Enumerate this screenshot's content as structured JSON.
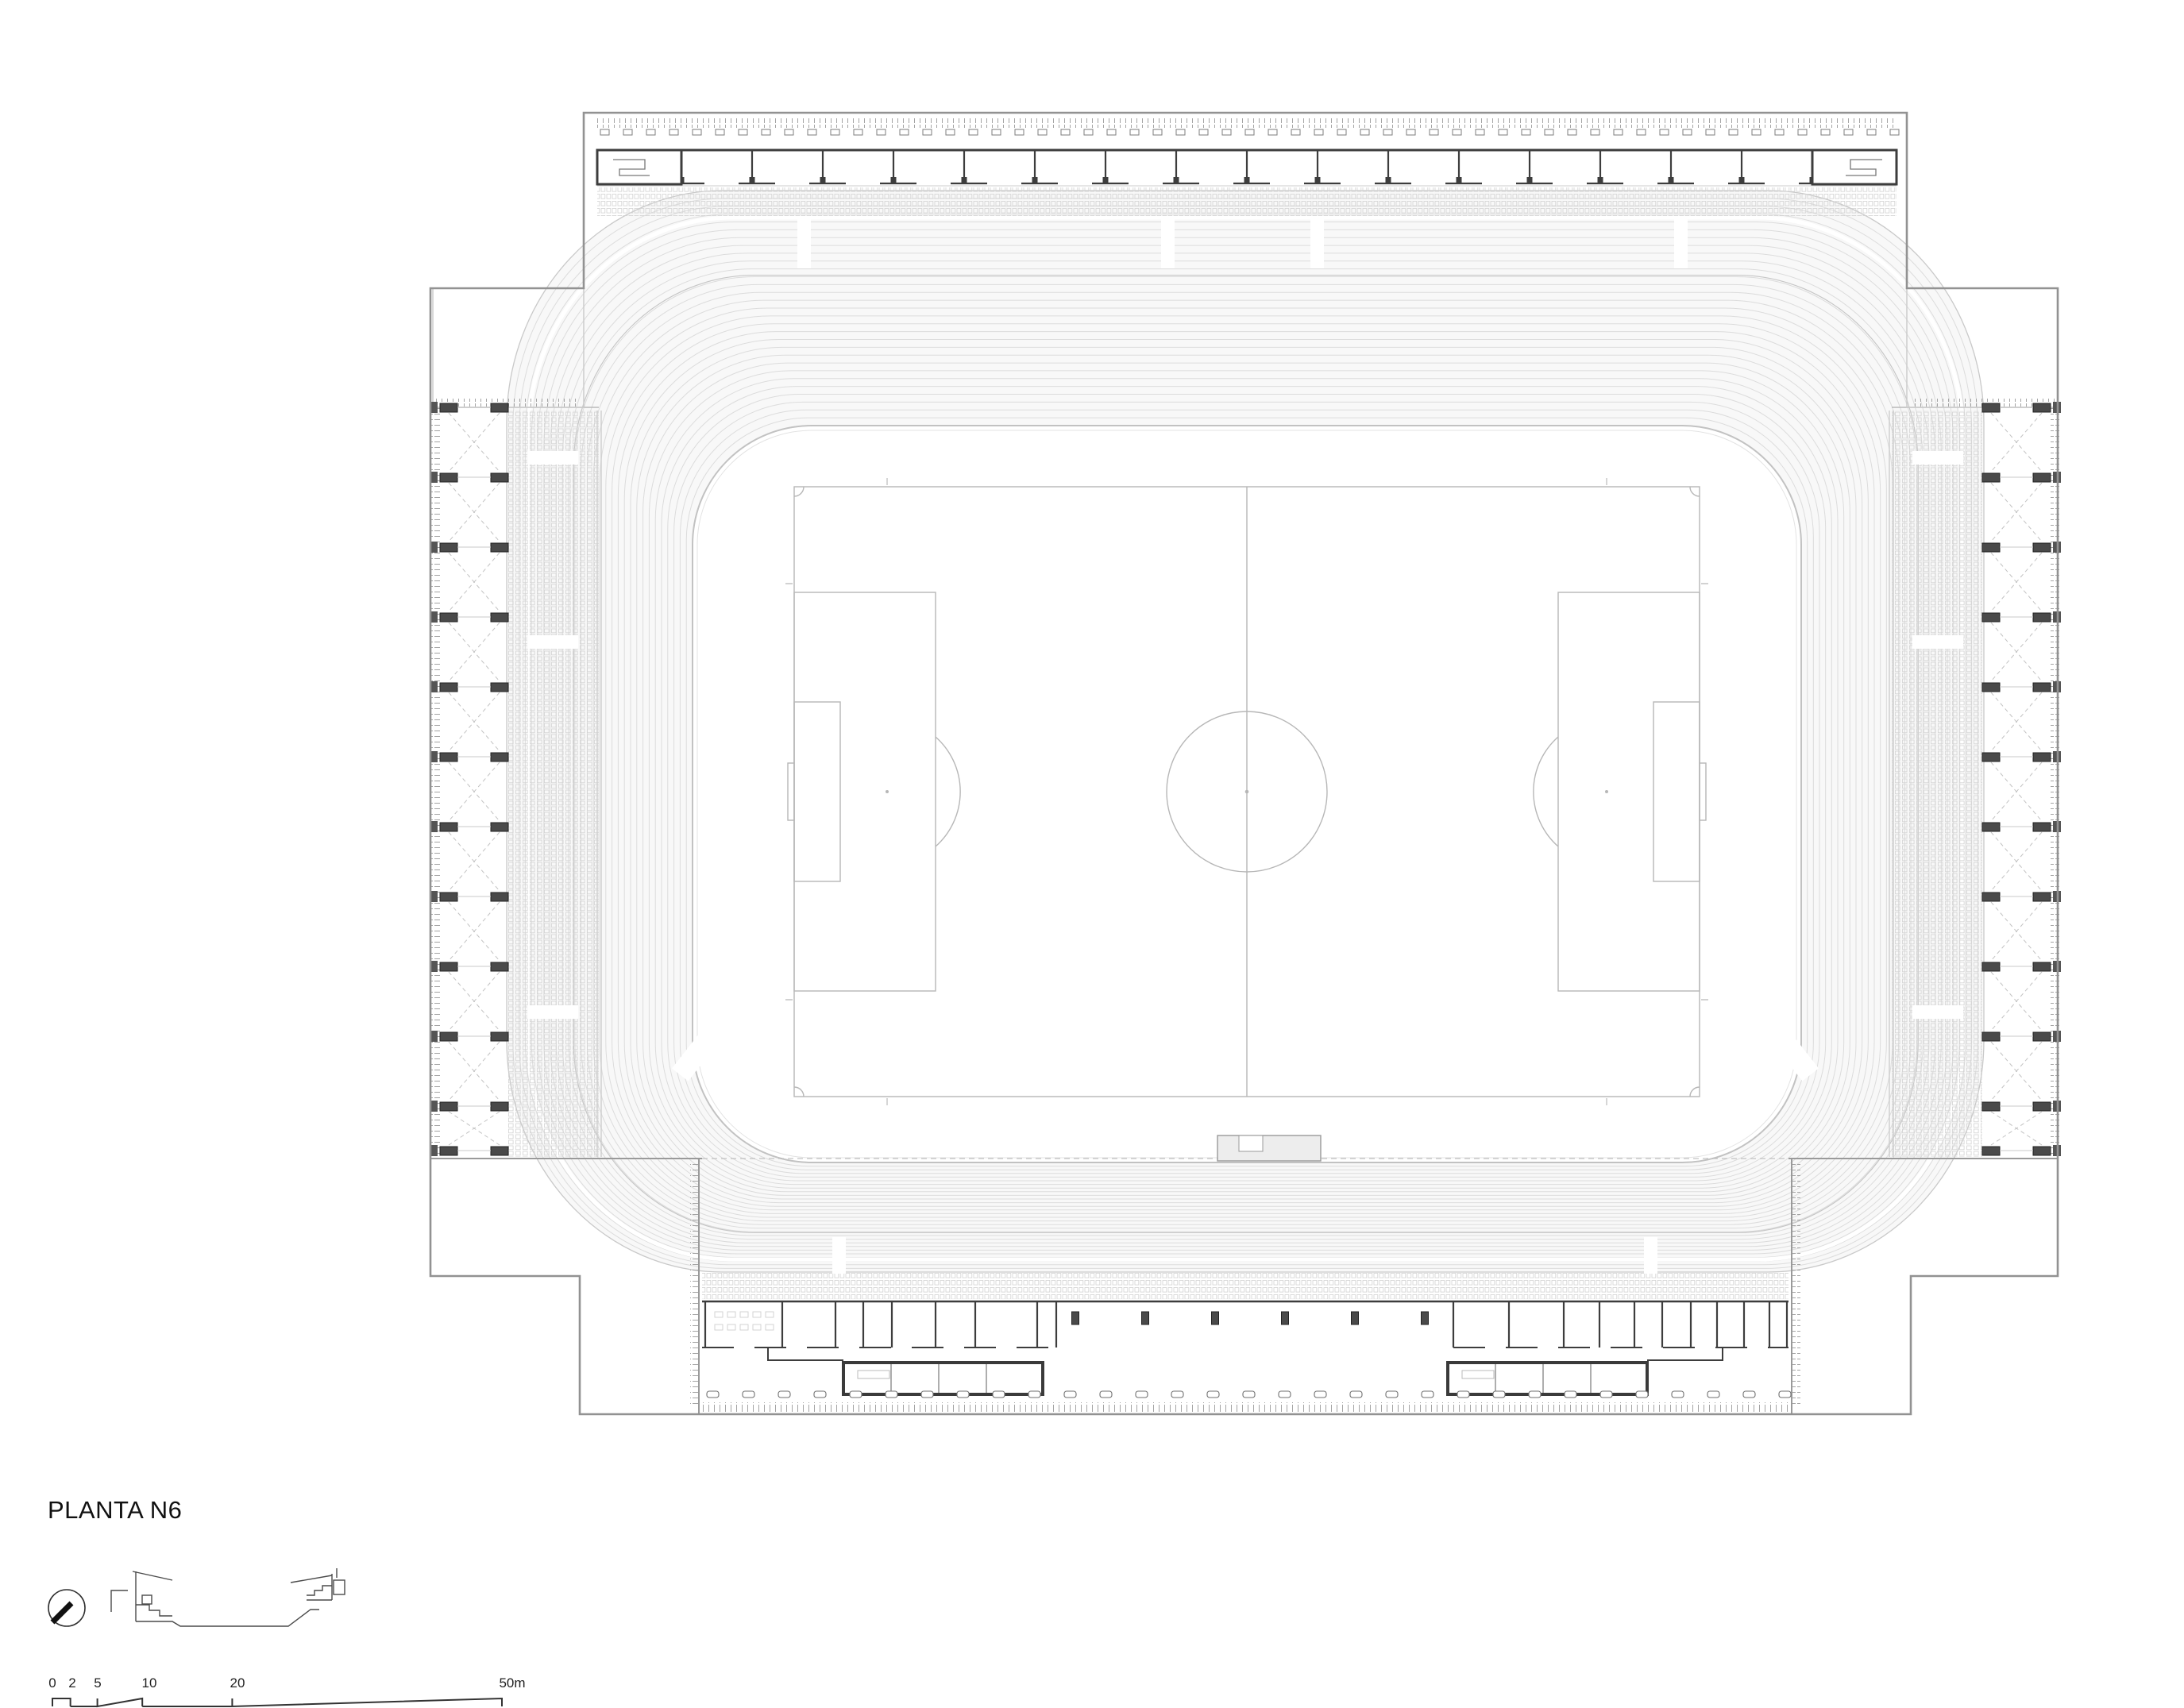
{
  "drawing": {
    "title": "PLANTA N6",
    "type_note": "stadium floor plan, level N6"
  },
  "scale_bar": {
    "marks": [
      0,
      2,
      5,
      10,
      20,
      50
    ],
    "labels": [
      "0",
      "2",
      "5",
      "10",
      "20",
      "50m"
    ],
    "unit": "m"
  },
  "icons": {
    "north": "north-arrow-icon",
    "section": "section-key-icon"
  },
  "colors": {
    "outline": "#929292",
    "light_line": "#c9c9c9",
    "row_line": "#dcdcdc",
    "dark_wall": "#3d3d3d",
    "column_fill": "#4a4a4a",
    "hatch": "#9a9a9a",
    "pitch_line": "#b7b7b7",
    "text": "#111111"
  }
}
